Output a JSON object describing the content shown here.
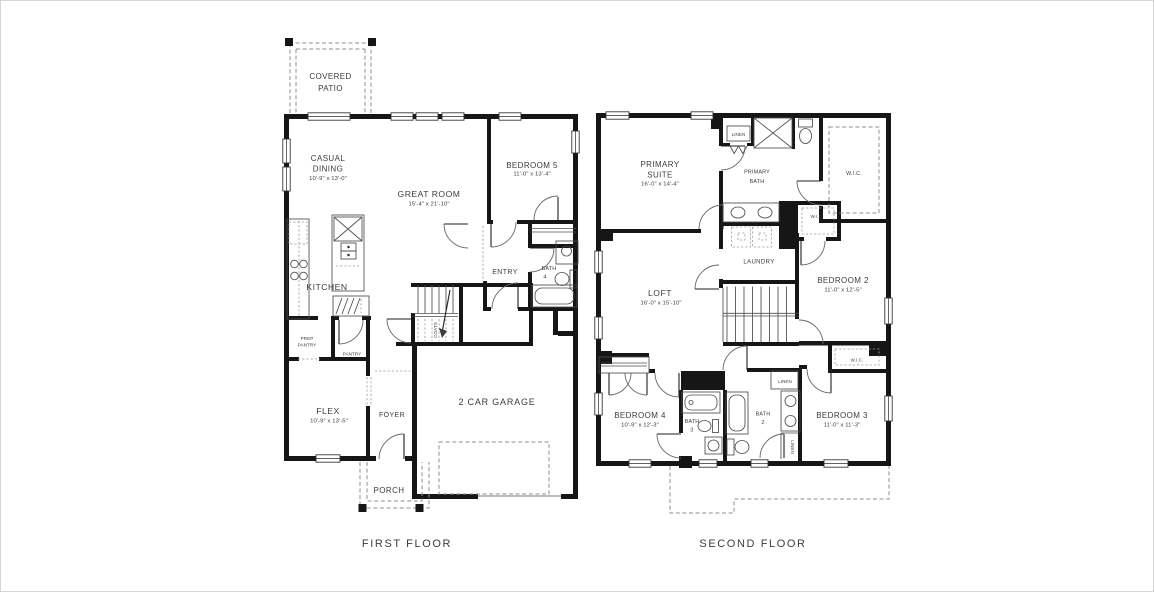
{
  "first_floor": {
    "title": "FIRST FLOOR",
    "covered_patio": {
      "line1": "COVERED",
      "line2": "PATIO"
    },
    "casual_dining": {
      "line1": "CASUAL",
      "line2": "DINING",
      "dims": "10'-9\" x 13'-0\""
    },
    "great_room": {
      "name": "GREAT ROOM",
      "dims": "15'-4\" x 21'-10\""
    },
    "bedroom_5": {
      "name": "BEDROOM 5",
      "dims": "11'-0\" x 13'-4\""
    },
    "kitchen": {
      "name": "KITCHEN"
    },
    "prep_pantry": {
      "line1": "PREP",
      "line2": "PANTRY"
    },
    "pantry": {
      "name": "PANTRY"
    },
    "entry": {
      "name": "ENTRY"
    },
    "bath_4": {
      "line1": "BATH",
      "line2": "4"
    },
    "coats": {
      "name": "COATS"
    },
    "flex": {
      "name": "FLEX",
      "dims": "10'-9\" x 13'-5\""
    },
    "foyer": {
      "name": "FOYER"
    },
    "garage": {
      "name": "2 CAR GARAGE"
    },
    "porch": {
      "name": "PORCH"
    }
  },
  "second_floor": {
    "title": "SECOND FLOOR",
    "primary_suite": {
      "line1": "PRIMARY",
      "line2": "SUITE",
      "dims": "16'-0\" x 14'-4\""
    },
    "primary_bath": {
      "line1": "PRIMARY",
      "line2": "BATH"
    },
    "linen_bath": {
      "name": "LINEN"
    },
    "wic_primary": {
      "name": "W.I.C."
    },
    "wic_hall": {
      "name": "W.I.C."
    },
    "laundry": {
      "name": "LAUNDRY"
    },
    "loft": {
      "name": "LOFT",
      "dims": "16'-0\" x 15'-10\""
    },
    "bedroom_2": {
      "name": "BEDROOM 2",
      "dims": "11'-0\" x 12'-5\""
    },
    "bedroom_3": {
      "name": "BEDROOM 3",
      "dims": "11'-0\" x 11'-3\""
    },
    "bedroom_4": {
      "name": "BEDROOM 4",
      "dims": "10'-9\" x 12'-3\""
    },
    "bath_2": {
      "line1": "BATH",
      "line2": "2"
    },
    "bath_3": {
      "line1": "BATH",
      "line2": "3"
    },
    "linen_hall": {
      "name": "LINEN"
    },
    "linen_bath2": {
      "name": "LINEN"
    },
    "wic_bedroom3": {
      "name": "W.I.C."
    }
  },
  "colors": {
    "wall": "#161616",
    "thin_line": "#4d4d4d",
    "dashed": "#8f8f8f",
    "text": "#3c3c3c"
  }
}
